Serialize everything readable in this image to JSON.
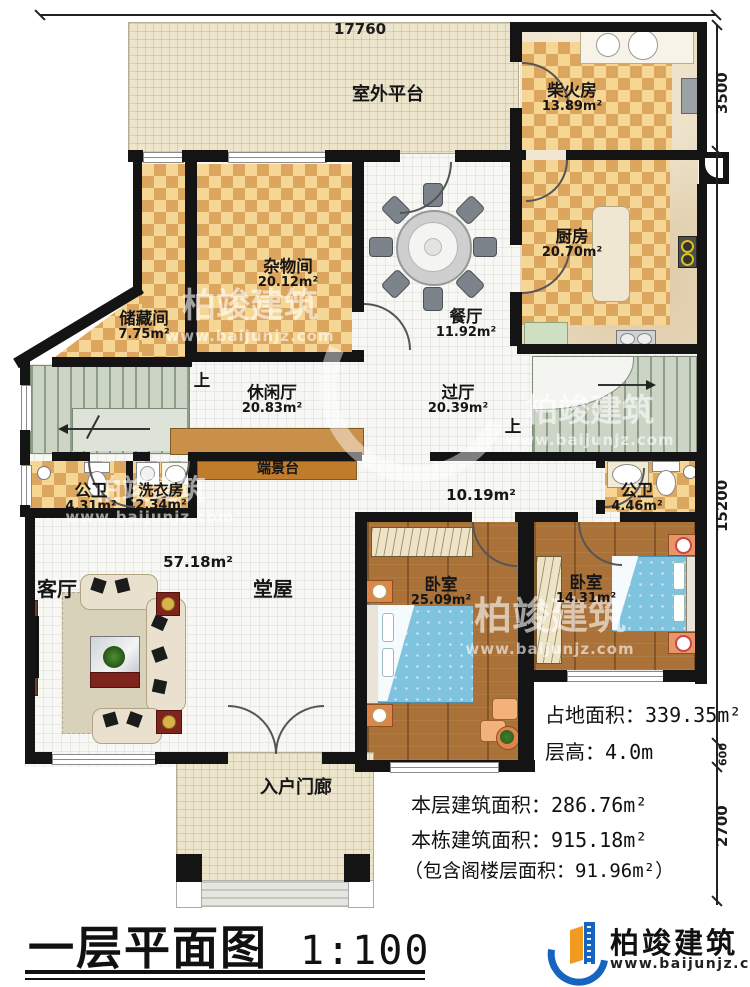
{
  "dimensions": {
    "top_width": "17760",
    "right_top": "3500",
    "right_middle": "15200",
    "right_low": "600",
    "right_bottom": "2700"
  },
  "rooms": {
    "platform": {
      "name": "室外平台"
    },
    "firewood": {
      "name": "柴火房",
      "area": "13.89m²"
    },
    "kitchen": {
      "name": "厨房",
      "area": "20.70m²"
    },
    "sundry": {
      "name": "杂物间",
      "area": "20.12m²"
    },
    "storage": {
      "name": "储藏间",
      "area": "7.75m²"
    },
    "dining": {
      "name": "餐厅",
      "area": "11.92m²"
    },
    "leisure": {
      "name": "休闲厅",
      "area": "20.83m²"
    },
    "hall": {
      "name": "过厅",
      "area": "20.39m²"
    },
    "console": {
      "name": "端景台"
    },
    "bath_left": {
      "name": "公卫",
      "area": "4.31m²"
    },
    "laundry": {
      "name": "洗衣房",
      "area": "2.34m²"
    },
    "bath_right": {
      "name": "公卫",
      "area": "4.46m²"
    },
    "living": {
      "name": "客厅",
      "area": "57.18m²"
    },
    "tangwu": {
      "name": "堂屋",
      "area": "10.19m²"
    },
    "bedroom1": {
      "name": "卧室",
      "area": "25.09m²"
    },
    "bedroom2": {
      "name": "卧室",
      "area": "14.31m²"
    },
    "porch": {
      "name": "入户门廊"
    }
  },
  "stairs": {
    "up1": "上",
    "up2": "上"
  },
  "stats": {
    "footprint": "占地面积：339.35m²",
    "height": "层高：4.0m",
    "floor_area": "本层建筑面积：286.76m²",
    "total_area": "本栋建筑面积：915.18m²",
    "attic_note": "（包含阁楼层面积：91.96m²）"
  },
  "footer": {
    "title": "一层平面图",
    "scale": "1:100",
    "brand": "柏竣建筑",
    "brand_url": "www.baijunjz.com"
  },
  "watermark": {
    "brand": "柏竣建筑",
    "url": "www.baijunjz.com"
  }
}
